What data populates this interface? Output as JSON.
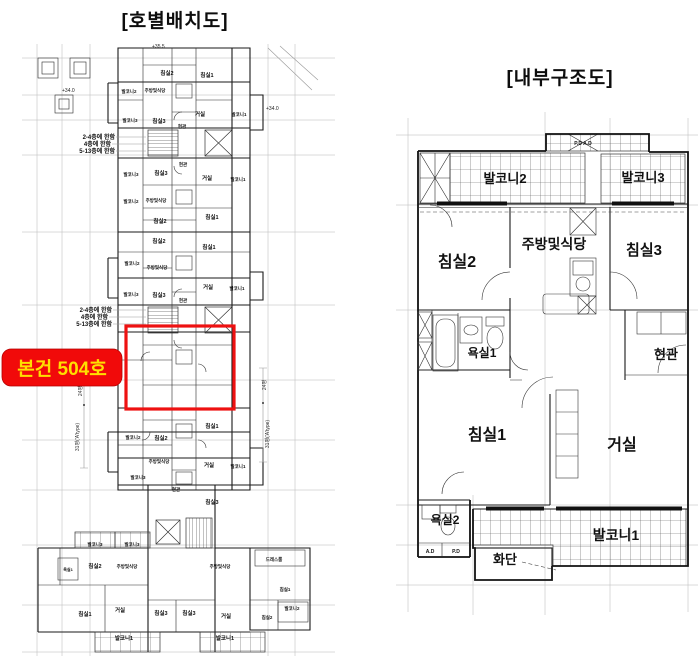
{
  "colors": {
    "highlight_box": "#ee1111",
    "label_bg": "#f10a0a",
    "label_text": "#ffdf00",
    "wall": "#1a1a1a",
    "grid": "#b6b6b6"
  },
  "left_plan": {
    "title": "[호별배치도]",
    "highlight": {
      "label": "본건 504호"
    },
    "elevations": {
      "top": "+35.5",
      "right": "+34.0",
      "left": "+34.0"
    },
    "notes_upper": [
      "2-4층에 한함",
      "4층에 한함",
      "5-13층에 한함"
    ],
    "notes_lower": [
      "2-4층에 한함",
      "4층에 한함",
      "5-13층에 한함"
    ],
    "dimensions": {
      "left_upper": "24평",
      "left_lower": "31평('A'type)",
      "right_upper": "24평",
      "right_lower": "31평('A'type)"
    },
    "labels": [
      "침실2",
      "침실1",
      "발코니2",
      "주방및식당",
      "거실",
      "발코니1",
      "발코니3",
      "침실3",
      "현관",
      "현관",
      "발코니3",
      "침실3",
      "거실",
      "발코니1",
      "발코니2",
      "주방및식당",
      "침실1",
      "침실2",
      "침실2",
      "침실1",
      "발코니2",
      "주방및식당",
      "거실",
      "발코니1",
      "발코니3",
      "침실3",
      "현관",
      "침실1",
      "발코니2",
      "침실2",
      "주방및식당",
      "거실",
      "발코니1",
      "발코니3",
      "현관",
      "침실3",
      "발코니3",
      "발코니3",
      "침실2",
      "주방및식당",
      "욕실1",
      "드레스룸",
      "주방및식당",
      "침실1",
      "침실1",
      "거실",
      "침실3",
      "침실3",
      "거실",
      "침실2",
      "발코니2",
      "발코니1",
      "발코니1"
    ]
  },
  "right_plan": {
    "title": "[내부구조도]",
    "rooms": {
      "balcony2": "발코니2",
      "balcony3": "발코니3",
      "bedroom2": "침실2",
      "kitchen": "주방및식당",
      "bedroom3": "침실3",
      "bath1": "욕실1",
      "entrance": "현관",
      "bedroom1": "침실1",
      "living": "거실",
      "bath2": "욕실2",
      "balcony1": "발코니1",
      "flowerbed": "화단",
      "shaft": "P.D A.D",
      "ad": "A.D",
      "pd": "P.D"
    }
  }
}
